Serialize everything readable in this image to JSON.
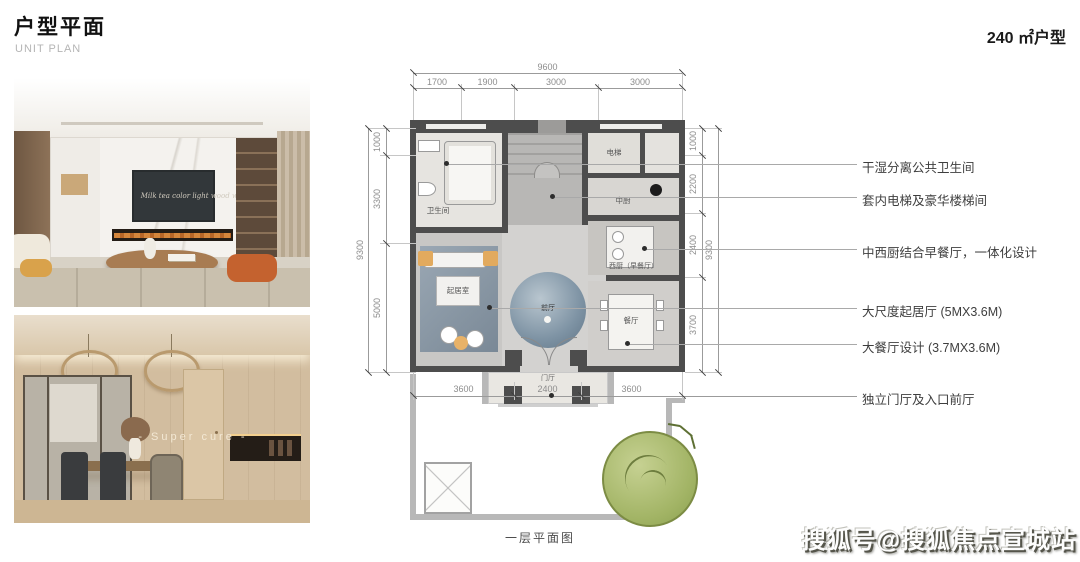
{
  "page": {
    "title": "户型平面",
    "subtitle": "UNIT PLAN",
    "unit_label": "240 ㎡户型",
    "plan_caption": "一层平面图",
    "watermark": "搜狐号@搜狐焦点宣城站"
  },
  "photos": {
    "living": {
      "overlay_text": "Milk tea color light wood wine"
    },
    "dining": {
      "overlay_text": "- Super cure -"
    }
  },
  "plan": {
    "rooms": {
      "bathroom": "卫生间",
      "elevator": "电梯",
      "chinese_kitchen": "中厨",
      "western_kitchen": "西厨（早餐厅）",
      "living_room": "起居室",
      "foyer": "前厅",
      "dining_room": "餐厅",
      "entry_porch": "门厅"
    },
    "dims": {
      "top_overall": "9600",
      "top_segments": [
        "1700",
        "1900",
        "3000",
        "3000"
      ],
      "left_overall": "9300",
      "left_segments": [
        "1000",
        "3300",
        "5000"
      ],
      "right_overall": "9300",
      "right_segments": [
        "1000",
        "2200",
        "2400",
        "3700"
      ],
      "bottom_segments": [
        "3600",
        "2400",
        "3600"
      ]
    }
  },
  "annotations": [
    {
      "label": "干湿分离公共卫生间"
    },
    {
      "label": "套内电梯及豪华楼梯间"
    },
    {
      "label": "中西厨结合早餐厅，一体化设计"
    },
    {
      "label": "大尺度起居厅 (5MX3.6M)"
    },
    {
      "label": "大餐厅设计 (3.7MX3.6M)"
    },
    {
      "label": "独立门厅及入口前厅"
    }
  ],
  "colors": {
    "wall_dark": "#4d4d4d",
    "wall_light": "#b8b8b8",
    "tree_green": "#a2b465",
    "rug_blue": "#8494a3",
    "accent_orange": "#e2aa5e",
    "leader_gray": "#a9a9a9"
  }
}
